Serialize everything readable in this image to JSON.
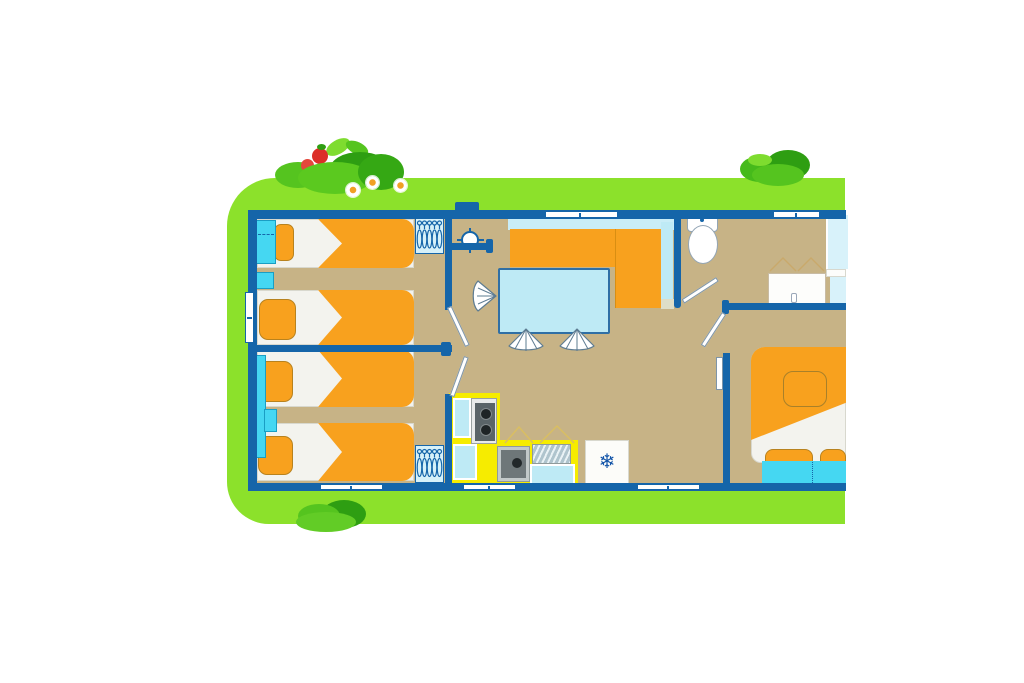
{
  "meta": {
    "kind": "floor-plan-illustration",
    "subject": "cartoon mobile-home / caravan floor plan on a green lawn"
  },
  "palette": {
    "background": "#FFFFFF",
    "lawn": "#8CE12B",
    "wall": "#1565A9",
    "floor": "#C7B386",
    "orange": "#F8A11E",
    "bright_cyan": "#45D7F2",
    "pale_cyan": "#C9EDF7",
    "table_cyan": "#BEEAF5",
    "soft_white": "#F3F3EE",
    "yellow": "#F6EC00",
    "sink_gray": "#6E7779",
    "bush_dark": "#2E9E12",
    "bush_mid": "#55C41F",
    "bush_light": "#7EDC2F",
    "strawberry_red": "#DC2F28",
    "flower_orange": "#F0A024"
  },
  "icons": {
    "fridge_snowflake": "❄"
  },
  "scene": {
    "areas": [
      "children-bedroom-front",
      "children-bedroom-back",
      "entrance-hall",
      "living-dining",
      "kitchen",
      "bathroom-wc",
      "master-bedroom"
    ],
    "furniture_counts": {
      "single_beds": 4,
      "double_bed": 1,
      "hanger_wardrobes": 2,
      "dining_chairs": 3,
      "sofa": 1,
      "dining_table": 1,
      "toilet": 1,
      "washbasins": 2,
      "shower": 1,
      "stove": 1,
      "kitchen_sink": 1,
      "fridge": 1
    },
    "decor": {
      "bushes": 3,
      "strawberries": 2,
      "daisies": 3
    }
  }
}
